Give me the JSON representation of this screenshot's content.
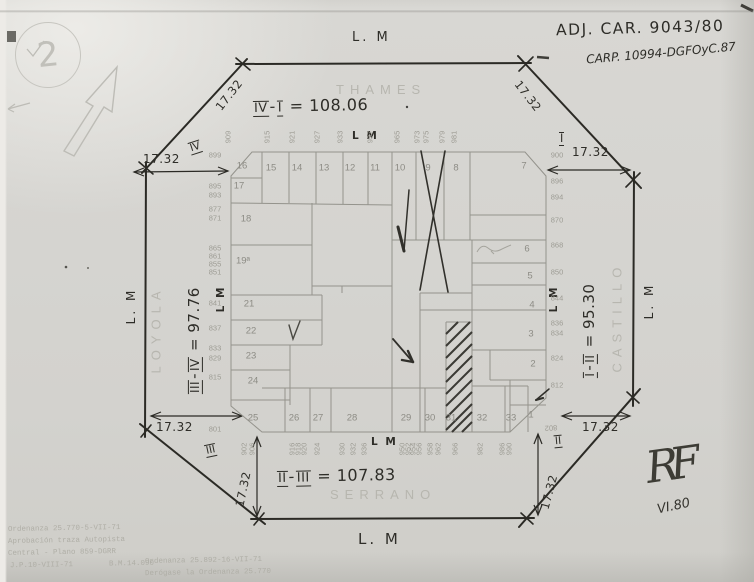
{
  "document": {
    "sheet_number": "2",
    "title_line1": "ADJ. CAR. 9043/80",
    "title_line2": "CARP. 10994-DGFOyC.87",
    "signature_initials": "RF",
    "signature_date": "VI.80"
  },
  "streets": {
    "top": "THAMES",
    "left": "LOYOLA",
    "right": "CASTILLO",
    "bottom": "SERRANO"
  },
  "municipal_line": {
    "outer": "L. M",
    "inner": "L M"
  },
  "dimensions": {
    "chamfer": "17.32",
    "top": {
      "a": "IV",
      "sep": "-",
      "b": "I",
      "val": "= 108.06"
    },
    "left": {
      "a": "III",
      "sep": "-",
      "b": "IV",
      "val": "= 97.76"
    },
    "right": {
      "a": "I",
      "sep": "-",
      "b": "II",
      "val": "= 95.30"
    },
    "bottom": {
      "a": "II",
      "sep": "-",
      "b": "III",
      "val": "= 107.83"
    }
  },
  "corner_markers": {
    "top_left": "IV",
    "top_right": "I",
    "bottom_right": "II",
    "bottom_left": "III"
  },
  "lots": {
    "top_row": [
      "16",
      "15",
      "14",
      "13",
      "12",
      "11",
      "10",
      "9",
      "8",
      "7"
    ],
    "left_col": [
      "17",
      "18",
      "19ª",
      "21",
      "22",
      "23",
      "24"
    ],
    "right_col": [
      "6",
      "5",
      "4",
      "3",
      "2"
    ],
    "bottom_row": [
      "25",
      "26",
      "27",
      "28",
      "29",
      "30",
      "31",
      "32",
      "33",
      "1"
    ]
  },
  "house_numbers": {
    "thames": [
      "909",
      "915",
      "921",
      "927",
      "933",
      "937",
      "965",
      "973",
      "975",
      "979",
      "981"
    ],
    "loyola": [
      "899",
      "895",
      "893",
      "877",
      "871",
      "865",
      "861",
      "855",
      "851",
      "841",
      "837",
      "833",
      "829",
      "815",
      "801"
    ],
    "castillo": [
      "900",
      "896",
      "894",
      "870",
      "868",
      "850",
      "844",
      "836",
      "834",
      "824",
      "812",
      "802"
    ],
    "serrano": [
      "902",
      "906",
      "916",
      "918",
      "920",
      "924",
      "930",
      "932",
      "936",
      "950",
      "952",
      "954",
      "956",
      "958",
      "962",
      "966",
      "982",
      "986",
      "990"
    ]
  },
  "notes": {
    "left": [
      "Ordenanza 25.770-5-VII-71",
      "Aprobación traza Autopista",
      "Central - Plano 859-DGRR",
      "J.P.10-VIII-71        B.M.14.090"
    ],
    "center": [
      "Ordenanza 25.892-16-VII-71",
      "Derógase la Ordenanza 25.770"
    ]
  }
}
